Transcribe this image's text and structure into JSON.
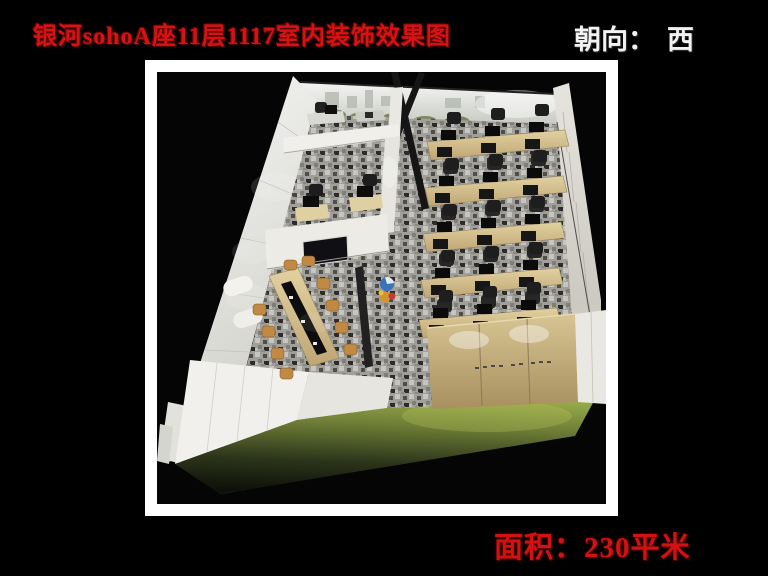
{
  "header": {
    "title": "银河sohoA座11层1117室内装饰效果图",
    "orientation_label": "朝向：",
    "orientation_value": "西"
  },
  "footer": {
    "area_label": "面积：",
    "area_value": "230平米"
  },
  "colors": {
    "page_background": "#000000",
    "title_red": "#d31414",
    "area_red": "#d01212",
    "orientation_white": "#f2f2f2",
    "frame_white": "#ffffff",
    "carpet_green": "#8fa03f",
    "carpet_gray": "#a09f9a",
    "desk_wood": "#cdb98e",
    "chair_black": "#1e1e1e",
    "meeting_chair_tan": "#c08a44"
  }
}
